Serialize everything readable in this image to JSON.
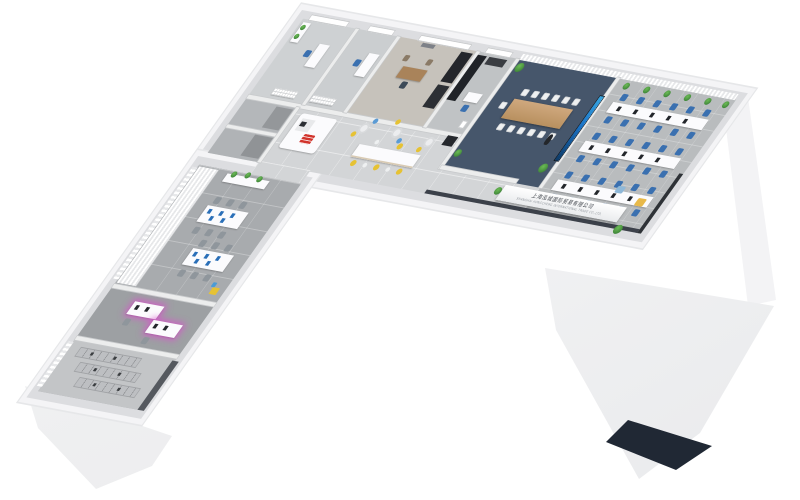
{
  "scene": {
    "type": "3d-isometric-office-floor-plan-render",
    "background": "#ffffff",
    "reception_sign": {
      "line1": "上海泓城国际贸易有限公司",
      "line2": "SHANGHAI HONGCHENG INTERNATIONAL TRADE CO.,LTD."
    },
    "rooms": [
      "private-office-1",
      "private-office-2",
      "manager-office",
      "filing-cabinet-room",
      "meeting-room",
      "open-office",
      "reception",
      "pantry-bar",
      "corridor",
      "small-utility-room-1",
      "small-utility-room-2",
      "team-workspace",
      "media-workstation-room",
      "storage-rack-room",
      "entrance"
    ]
  },
  "palette": {
    "wall": "#dcdde0",
    "wallFace": "#f4f4f6",
    "floorTile": "#d3d5d7",
    "meetingCarpet": "#46566b",
    "officeCarpet": "#b9bcbe",
    "stemCarpet": "#a8abae",
    "accentBlue": "#3a70b0",
    "accentYellow": "#e6c233",
    "accentRed": "#d1342c",
    "plantGreen": "#3f8f3a",
    "screenBlue": "#1b74c8",
    "darkFurniture": "#24262b",
    "entryDark": "#202834"
  }
}
